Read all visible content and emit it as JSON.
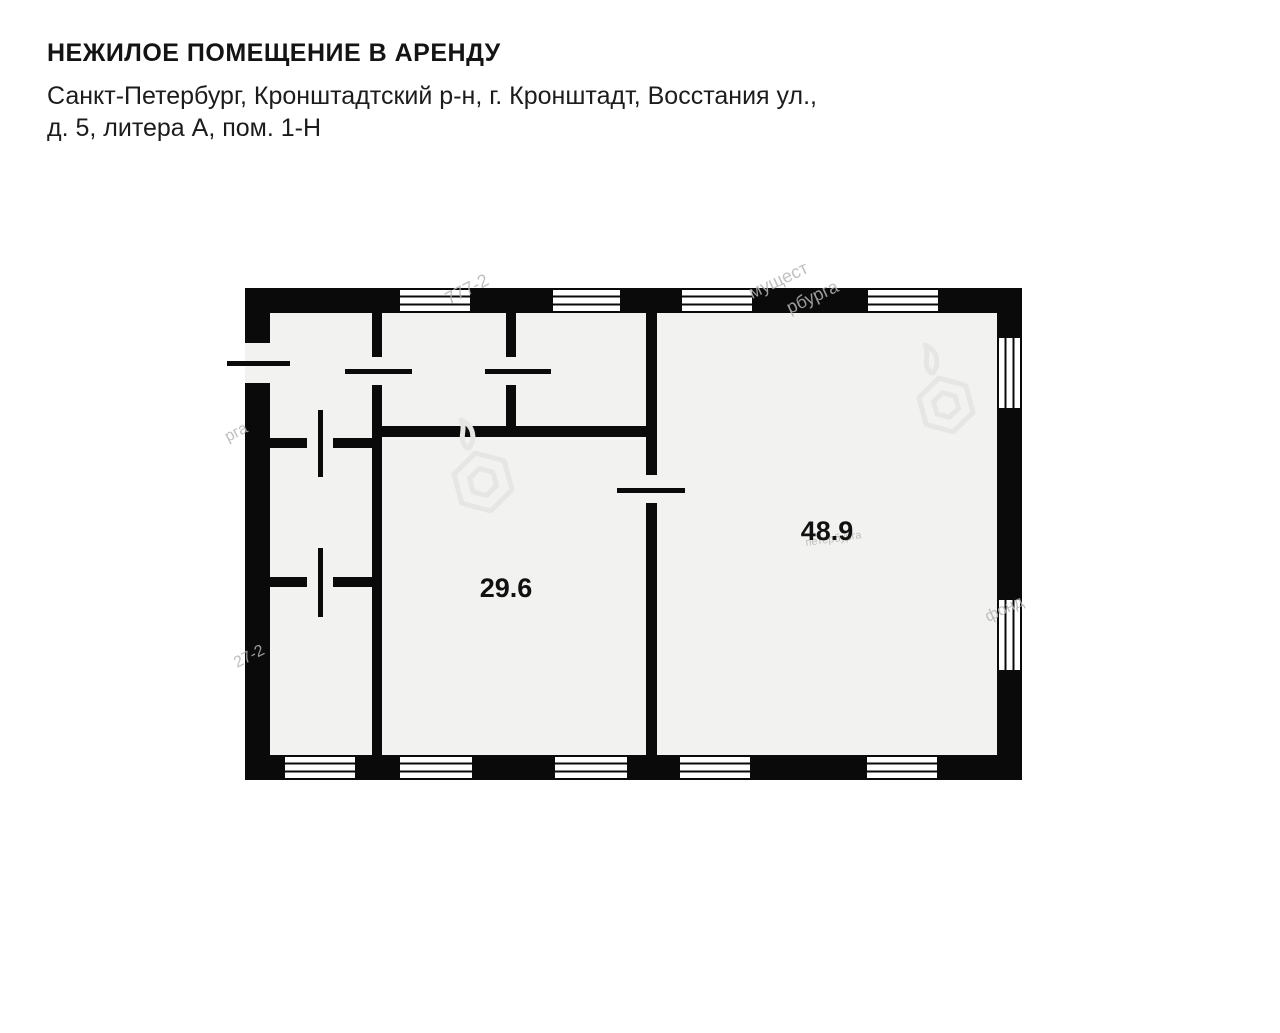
{
  "header": {
    "title": "НЕЖИЛОЕ ПОМЕЩЕНИЕ В АРЕНДУ",
    "address_line1": "Санкт-Петербург, Кронштадтский р-н, г. Кронштадт, Восстания ул.,",
    "address_line2": "д. 5, литера А, пом. 1-Н"
  },
  "floor_plan": {
    "rooms": [
      {
        "name": "room-29-6",
        "area_label": "29.6"
      },
      {
        "name": "room-48-9",
        "area_label": "48.9"
      }
    ],
    "colors": {
      "wall": "#0a0a0a",
      "interior": "#f2f2f1",
      "label": "#111111",
      "watermark": "#b5b5b5"
    },
    "watermarks": {
      "fragments": [
        {
          "text": "777-2"
        },
        {
          "text": "мущест"
        },
        {
          "text": "рбурга"
        },
        {
          "text": "рга"
        },
        {
          "text": "27-2"
        },
        {
          "text": "фонд"
        },
        {
          "text": "петербурга"
        }
      ]
    }
  }
}
